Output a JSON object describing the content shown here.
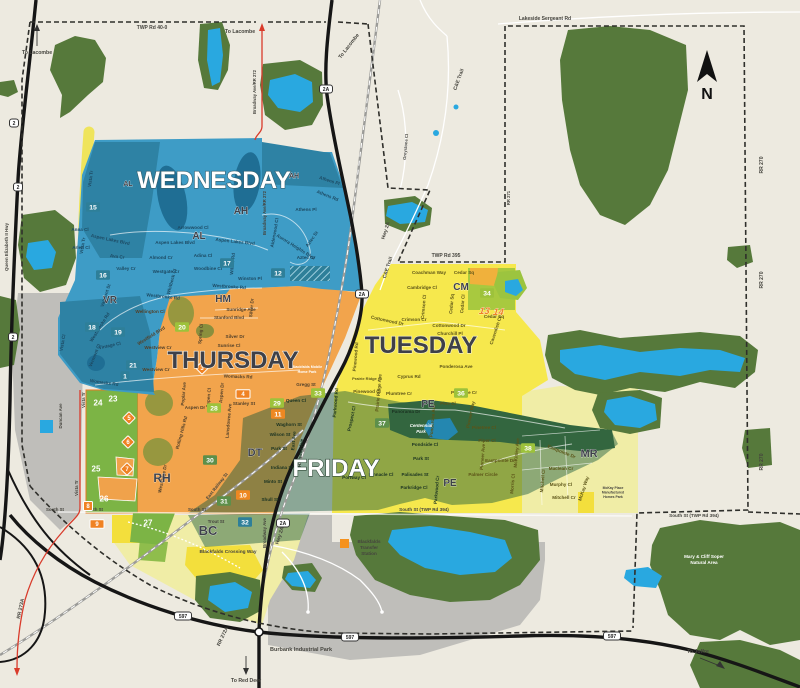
{
  "compass": {
    "label": "N"
  },
  "colors": {
    "wb": "#1D4A63",
    "th": "#53412A",
    "fr": "#1B3322",
    "tu": "#5C5418",
    "be": "#45443E",
    "wh": "#FFFFFF",
    "wednesday": "#3E9CC6",
    "thursday": "#F2A44C",
    "tuesday": "#F6E84D",
    "friday_overlay": "#14563C",
    "pale_yellow": "#F0EDA6",
    "zone_green": "#7CB445",
    "forest": "#56793B",
    "water": "#29A8E0",
    "gray": "#BFBEBA",
    "teal_box": "#2E7F99",
    "lime_box": "#9DC23B",
    "dgreen_box": "#5D8F4A",
    "orange_box": "#EE8822",
    "marker_orange": "#F08223",
    "red_route": "#D93B2B"
  },
  "day_titles": [
    {
      "t": "WEDNESDAY",
      "x": 214,
      "y": 188,
      "c": "#FFFFFF",
      "o": "#35606F"
    },
    {
      "t": "THURSDAY",
      "x": 233,
      "y": 368,
      "c": "#3E4049",
      "o": "#F7EFE2"
    },
    {
      "t": "TUESDAY",
      "x": 421,
      "y": 353,
      "c": "#3E4049",
      "o": "#F7F3C8"
    },
    {
      "t": "FRIDAY",
      "x": 336,
      "y": 476,
      "c": "#FFFFFF",
      "o": "#2F4A38"
    }
  ],
  "neighborhoods": [
    {
      "t": "AL",
      "x": 128,
      "y": 186,
      "s": 7
    },
    {
      "t": "AL",
      "x": 199,
      "y": 239,
      "s": 10
    },
    {
      "t": "AH",
      "x": 294,
      "y": 178,
      "s": 7
    },
    {
      "t": "AH",
      "x": 241,
      "y": 214,
      "s": 10
    },
    {
      "t": "VR",
      "x": 110,
      "y": 303,
      "s": 10
    },
    {
      "t": "HM",
      "x": 223,
      "y": 302,
      "s": 10
    },
    {
      "t": "RH",
      "x": 162,
      "y": 482,
      "s": 12
    },
    {
      "t": "DT",
      "x": 255,
      "y": 456,
      "s": 11
    },
    {
      "t": "BC",
      "x": 208,
      "y": 535,
      "s": 13
    },
    {
      "t": "CM",
      "x": 461,
      "y": 290,
      "s": 10
    },
    {
      "t": "PE",
      "x": 428,
      "y": 407,
      "s": 10
    },
    {
      "t": "PE",
      "x": 450,
      "y": 486,
      "s": 10
    },
    {
      "t": "MR",
      "x": 589,
      "y": 457,
      "s": 11
    }
  ],
  "zone_numbers": [
    {
      "t": "12",
      "x": 278,
      "y": 273,
      "b": "teal"
    },
    {
      "t": "15",
      "x": 93,
      "y": 207,
      "b": "teal"
    },
    {
      "t": "16",
      "x": 103,
      "y": 275,
      "b": "teal"
    },
    {
      "t": "17",
      "x": 227,
      "y": 263,
      "b": "teal"
    },
    {
      "t": "18",
      "x": 92,
      "y": 327,
      "b": "teal"
    },
    {
      "t": "19",
      "x": 118,
      "y": 332,
      "b": "teal"
    },
    {
      "t": "21",
      "x": 133,
      "y": 365,
      "b": "teal"
    },
    {
      "t": "1",
      "x": 125,
      "y": 376,
      "b": "teal"
    },
    {
      "t": "32",
      "x": 245,
      "y": 522,
      "b": "teal"
    },
    {
      "t": "20",
      "x": 182,
      "y": 327,
      "b": "lime"
    },
    {
      "t": "28",
      "x": 214,
      "y": 408,
      "b": "lime"
    },
    {
      "t": "29",
      "x": 277,
      "y": 403,
      "b": "lime"
    },
    {
      "t": "33",
      "x": 318,
      "y": 393,
      "b": "lime"
    },
    {
      "t": "34",
      "x": 487,
      "y": 293,
      "b": "lime"
    },
    {
      "t": "36",
      "x": 461,
      "y": 393,
      "b": "lime"
    },
    {
      "t": "38",
      "x": 528,
      "y": 448,
      "b": "lime"
    },
    {
      "t": "30",
      "x": 210,
      "y": 460,
      "b": "dgreen"
    },
    {
      "t": "31",
      "x": 224,
      "y": 501,
      "b": "dgreen"
    },
    {
      "t": "37",
      "x": 382,
      "y": 423,
      "b": "dgreen"
    },
    {
      "t": "10",
      "x": 243,
      "y": 495,
      "b": "orange"
    },
    {
      "t": "11",
      "x": 278,
      "y": 414,
      "b": "orange"
    },
    {
      "t": "23",
      "x": 113,
      "y": 399,
      "b": "plain"
    },
    {
      "t": "24",
      "x": 98,
      "y": 403,
      "b": "plain"
    },
    {
      "t": "25",
      "x": 96,
      "y": 469,
      "b": "plain"
    },
    {
      "t": "26",
      "x": 104,
      "y": 499,
      "b": "plain"
    },
    {
      "t": "27",
      "x": 148,
      "y": 523,
      "b": "plain"
    }
  ],
  "markers": [
    {
      "t": "3",
      "x": 202,
      "y": 368,
      "k": "diamond"
    },
    {
      "t": "5",
      "x": 129,
      "y": 418,
      "k": "diamond"
    },
    {
      "t": "6",
      "x": 128,
      "y": 442,
      "k": "diamond"
    },
    {
      "t": "7",
      "x": 127,
      "y": 469,
      "k": "diamond"
    },
    {
      "t": "4",
      "x": 243,
      "y": 394,
      "k": "rect"
    },
    {
      "t": "9",
      "x": 97,
      "y": 524,
      "k": "rect"
    },
    {
      "t": "8",
      "x": 88,
      "y": 506,
      "k": "square"
    },
    {
      "t": "13",
      "x": 484,
      "y": 311,
      "k": "plain"
    },
    {
      "t": "14",
      "x": 498,
      "y": 312,
      "k": "plain"
    }
  ],
  "shields": [
    {
      "t": "2",
      "x": 14,
      "y": 123
    },
    {
      "t": "2",
      "x": 18,
      "y": 187
    },
    {
      "t": "2",
      "x": 13,
      "y": 337
    },
    {
      "t": "2A",
      "x": 326,
      "y": 89
    },
    {
      "t": "2A",
      "x": 362,
      "y": 294
    },
    {
      "t": "2A",
      "x": 283,
      "y": 523
    },
    {
      "t": "597",
      "x": 183,
      "y": 616
    },
    {
      "t": "597",
      "x": 350,
      "y": 637
    },
    {
      "t": "597",
      "x": 612,
      "y": 636
    }
  ],
  "edge_labels": [
    {
      "t": "TWP Rd 40-0",
      "x": 152,
      "y": 29
    },
    {
      "t": "Lakeside Sergeant Rd",
      "x": 545,
      "y": 20
    },
    {
      "t": "TWP Rd 395",
      "x": 446,
      "y": 257
    },
    {
      "t": "South St",
      "x": 55,
      "y": 511,
      "s": 4.4
    },
    {
      "t": "South St",
      "x": 94,
      "y": 511,
      "s": 4.4
    },
    {
      "t": "South St",
      "x": 197,
      "y": 511,
      "s": 4.4
    },
    {
      "t": "South St (TWP Rd 394)",
      "x": 424,
      "y": 511,
      "s": 4.6
    },
    {
      "t": "South St (TWP Rd 394)",
      "x": 694,
      "y": 517,
      "s": 4.6
    },
    {
      "t": "RR 270",
      "x": 763,
      "y": 165,
      "r": -90
    },
    {
      "t": "RR 270",
      "x": 763,
      "y": 280,
      "r": -90
    },
    {
      "t": "RR 270",
      "x": 763,
      "y": 462,
      "r": -90
    },
    {
      "t": "RR 273A",
      "x": 22,
      "y": 609,
      "r": -78
    },
    {
      "t": "RR 272A",
      "x": 224,
      "y": 637,
      "r": -65
    },
    {
      "t": "Queen Elizabeth II Hwy",
      "x": 8,
      "y": 247,
      "r": -90,
      "s": 4.4
    },
    {
      "t": "Broadway Ave/RR 272",
      "x": 256,
      "y": 92,
      "r": -90,
      "s": 4.2
    },
    {
      "t": "Broadway Ave/RR 272",
      "x": 266,
      "y": 213,
      "r": -90,
      "s": 4.2
    },
    {
      "t": "Hwy 2A",
      "x": 387,
      "y": 231,
      "r": -72
    },
    {
      "t": "Hwy 2A",
      "x": 281,
      "y": 536,
      "r": -72
    },
    {
      "t": "Duncan Ave",
      "x": 62,
      "y": 416,
      "r": -90,
      "s": 4.4
    },
    {
      "t": "Vista Tr",
      "x": 85,
      "y": 400,
      "r": -90,
      "s": 4.4
    },
    {
      "t": "Vista Tr",
      "x": 78,
      "y": 488,
      "r": -90,
      "s": 4.4
    },
    {
      "t": "East Railway St",
      "x": 218,
      "y": 487,
      "r": -52,
      "s": 4.4
    },
    {
      "t": "Broadway Ave",
      "x": 266,
      "y": 533,
      "r": -90,
      "s": 4.4
    },
    {
      "t": "Trout St",
      "x": 216,
      "y": 523,
      "s": 4.4
    },
    {
      "t": "C&E Trail",
      "x": 460,
      "y": 80,
      "r": -70
    },
    {
      "t": "C&E Trail",
      "x": 389,
      "y": 268,
      "r": -72
    },
    {
      "t": "Greystone Cl",
      "x": 407,
      "y": 147,
      "r": -85,
      "s": 4.2
    },
    {
      "t": "RR 271",
      "x": 510,
      "y": 198,
      "r": -90,
      "s": 4.2
    },
    {
      "t": "Blackfalds Crossing Way",
      "x": 228,
      "y": 553,
      "s": 4.8
    }
  ],
  "directions": [
    {
      "t": "To Lacombe",
      "x": 37,
      "y": 54
    },
    {
      "t": "To Lacombe",
      "x": 240,
      "y": 33
    },
    {
      "t": "To Lacombe",
      "x": 350,
      "y": 47,
      "r": -52
    },
    {
      "t": "To Red Deer",
      "x": 246,
      "y": 682
    },
    {
      "t": "To Joffre",
      "x": 698,
      "y": 653
    }
  ],
  "landmarks": [
    {
      "t": "Blackfalds",
      "x": 369,
      "y": 543
    },
    {
      "t": "Transfer",
      "x": 369,
      "y": 549
    },
    {
      "t": "Station",
      "x": 369,
      "y": 555
    },
    {
      "t": "Burbank Industrial Park",
      "x": 301,
      "y": 651,
      "s": 5.5
    },
    {
      "t": "Centennial",
      "x": 421,
      "y": 427,
      "c": "wh",
      "i": 1,
      "s": 4.4
    },
    {
      "t": "Park",
      "x": 421,
      "y": 433,
      "c": "wh",
      "i": 1,
      "s": 4.4
    },
    {
      "t": "Mary & Cliff Soper",
      "x": 704,
      "y": 558,
      "c": "wh"
    },
    {
      "t": "Natural Area",
      "x": 704,
      "y": 564,
      "c": "wh"
    },
    {
      "t": "Blackfalds Mobile",
      "x": 307,
      "y": 368,
      "c": "wh",
      "s": 3.6
    },
    {
      "t": "Home Park",
      "x": 307,
      "y": 373,
      "c": "wh",
      "s": 3.6
    },
    {
      "t": "McKay Place",
      "x": 613,
      "y": 489,
      "s": 3.4
    },
    {
      "t": "Manufactured",
      "x": 613,
      "y": 493.5,
      "s": 3.4
    },
    {
      "t": "Homes Park",
      "x": 613,
      "y": 498,
      "s": 3.4
    }
  ],
  "streets": [
    {
      "t": "Vista Tr",
      "x": 92,
      "y": 179,
      "r": -82,
      "c": "wb"
    },
    {
      "t": "Athens Pl",
      "x": 329,
      "y": 182,
      "r": 18,
      "c": "wb"
    },
    {
      "t": "Athens Rd",
      "x": 327,
      "y": 197,
      "r": 22,
      "c": "wb"
    },
    {
      "t": "Athens Pl",
      "x": 306,
      "y": 211,
      "c": "wb"
    },
    {
      "t": "Arrowwood Cl",
      "x": 193,
      "y": 229,
      "c": "wb"
    },
    {
      "t": "Aspen Lakes Blvd",
      "x": 110,
      "y": 241,
      "r": 12,
      "c": "wb"
    },
    {
      "t": "Anna Cl",
      "x": 80,
      "y": 231,
      "c": "wb"
    },
    {
      "t": "Arlen Cl",
      "x": 81,
      "y": 249,
      "c": "wb"
    },
    {
      "t": "Ava Cr",
      "x": 117,
      "y": 258,
      "r": 8,
      "c": "wb"
    },
    {
      "t": "Aspen Lakes Blvd",
      "x": 175,
      "y": 244,
      "c": "wb"
    },
    {
      "t": "Aspen Lakes Blvd",
      "x": 235,
      "y": 243,
      "r": 6,
      "c": "wb"
    },
    {
      "t": "Almond Cr",
      "x": 161,
      "y": 259,
      "c": "wb"
    },
    {
      "t": "Adina Cl",
      "x": 203,
      "y": 257,
      "c": "wb"
    },
    {
      "t": "Woodbine Cl",
      "x": 208,
      "y": 270,
      "c": "wb"
    },
    {
      "t": "Willow Rd",
      "x": 234,
      "y": 264,
      "r": -85,
      "c": "wb"
    },
    {
      "t": "Winston Pl",
      "x": 250,
      "y": 280,
      "c": "wb"
    },
    {
      "t": "Westbrooke Rd",
      "x": 229,
      "y": 288,
      "r": 4,
      "c": "wb"
    },
    {
      "t": "Westbrooke Rd",
      "x": 163,
      "y": 298,
      "r": 6,
      "c": "wb"
    },
    {
      "t": "Valley Cr",
      "x": 126,
      "y": 270,
      "c": "wb"
    },
    {
      "t": "Westgate Cr",
      "x": 166,
      "y": 273,
      "c": "wb"
    },
    {
      "t": "Whitbeck Cl",
      "x": 173,
      "y": 282,
      "r": -75,
      "c": "wb"
    },
    {
      "t": "Vista Tr",
      "x": 84,
      "y": 246,
      "r": -80,
      "c": "wb"
    },
    {
      "t": "Valmont St",
      "x": 107,
      "y": 296,
      "r": -72,
      "c": "wb"
    },
    {
      "t": "Vermont Cl",
      "x": 96,
      "y": 356,
      "r": -68,
      "c": "wb"
    },
    {
      "t": "Westbrooke Rd",
      "x": 101,
      "y": 328,
      "r": -58,
      "c": "wb"
    },
    {
      "t": "Aurora Heights Blvd",
      "x": 295,
      "y": 248,
      "r": 32,
      "c": "wb"
    },
    {
      "t": "Alderwood Cl",
      "x": 276,
      "y": 233,
      "r": -80,
      "c": "wb"
    },
    {
      "t": "Aztec St",
      "x": 313,
      "y": 240,
      "r": -55,
      "c": "wb"
    },
    {
      "t": "Aztec Cr",
      "x": 306,
      "y": 259,
      "c": "wb"
    },
    {
      "t": "Vintage Cl",
      "x": 110,
      "y": 347,
      "r": -12,
      "c": "wb"
    },
    {
      "t": "Vista Cl",
      "x": 64,
      "y": 343,
      "r": -80,
      "c": "wb"
    },
    {
      "t": "Womacks Rd",
      "x": 104,
      "y": 384,
      "r": 8,
      "c": "wb"
    },
    {
      "t": "Wellington Cl",
      "x": 150,
      "y": 313,
      "c": "th"
    },
    {
      "t": "Westfield Blvd",
      "x": 152,
      "y": 337,
      "r": -32,
      "c": "th"
    },
    {
      "t": "Westview Cr",
      "x": 158,
      "y": 349,
      "c": "th"
    },
    {
      "t": "Westview Cr",
      "x": 156,
      "y": 371,
      "c": "th"
    },
    {
      "t": "Sunridge Ave",
      "x": 241,
      "y": 311,
      "c": "th"
    },
    {
      "t": "Stanford Blvd",
      "x": 229,
      "y": 319,
      "c": "th"
    },
    {
      "t": "Silver Dr",
      "x": 235,
      "y": 338,
      "c": "th"
    },
    {
      "t": "Sunrise Cl",
      "x": 229,
      "y": 347,
      "c": "th"
    },
    {
      "t": "Spring Cl",
      "x": 202,
      "y": 334,
      "r": -85,
      "c": "th"
    },
    {
      "t": "Silver Dr",
      "x": 253,
      "y": 308,
      "r": -85,
      "c": "th"
    },
    {
      "t": "Womacks Rd",
      "x": 238,
      "y": 378,
      "r": 2,
      "c": "th"
    },
    {
      "t": "Poplar Ave",
      "x": 185,
      "y": 394,
      "r": -85,
      "c": "th"
    },
    {
      "t": "Aspen Dr",
      "x": 195,
      "y": 409,
      "c": "th"
    },
    {
      "t": "Aspen Cl",
      "x": 210,
      "y": 398,
      "r": -85,
      "c": "th"
    },
    {
      "t": "Aspen Dr",
      "x": 223,
      "y": 393,
      "r": -85,
      "c": "th"
    },
    {
      "t": "Lansdowne Ave",
      "x": 230,
      "y": 421,
      "r": -85,
      "c": "th"
    },
    {
      "t": "Stanley St",
      "x": 244,
      "y": 405,
      "c": "th"
    },
    {
      "t": "Gregg St",
      "x": 306,
      "y": 386,
      "c": "th"
    },
    {
      "t": "Westridge Dr",
      "x": 164,
      "y": 479,
      "r": -78,
      "c": "th"
    },
    {
      "t": "Rolling Hills Rd",
      "x": 183,
      "y": 433,
      "r": -75,
      "c": "th"
    },
    {
      "t": "Waghorn St",
      "x": 289,
      "y": 426,
      "c": "fr"
    },
    {
      "t": "Wilson St",
      "x": 280,
      "y": 436,
      "c": "fr"
    },
    {
      "t": "Park St",
      "x": 279,
      "y": 450,
      "c": "fr"
    },
    {
      "t": "Indiana St",
      "x": 282,
      "y": 469,
      "c": "fr"
    },
    {
      "t": "Minto St",
      "x": 273,
      "y": 483,
      "c": "fr"
    },
    {
      "t": "Shull St",
      "x": 270,
      "y": 501,
      "c": "fr"
    },
    {
      "t": "East Ave",
      "x": 295,
      "y": 441,
      "r": -85,
      "c": "fr"
    },
    {
      "t": "Highway Ave",
      "x": 302,
      "y": 453,
      "r": -85,
      "c": "fr"
    },
    {
      "t": "Queen Cl",
      "x": 296,
      "y": 402,
      "c": "fr"
    },
    {
      "t": "Panorama Dr",
      "x": 406,
      "y": 413,
      "c": "fr"
    },
    {
      "t": "Pondside Cl",
      "x": 425,
      "y": 446,
      "c": "fr"
    },
    {
      "t": "Park St",
      "x": 421,
      "y": 460,
      "c": "fr"
    },
    {
      "t": "Palisades St",
      "x": 415,
      "y": 476,
      "c": "fr"
    },
    {
      "t": "Parkridge Cl",
      "x": 414,
      "y": 489,
      "c": "fr"
    },
    {
      "t": "Pinnacle Cl",
      "x": 381,
      "y": 476,
      "c": "fr"
    },
    {
      "t": "Portway Cl",
      "x": 354,
      "y": 479,
      "c": "fr"
    },
    {
      "t": "Parkwood Cr",
      "x": 438,
      "y": 490,
      "r": -85,
      "c": "fr"
    },
    {
      "t": "Parkwood Rd",
      "x": 337,
      "y": 403,
      "r": -85,
      "c": "fr"
    },
    {
      "t": "Prospect Cl",
      "x": 353,
      "y": 419,
      "r": -78,
      "c": "fr"
    },
    {
      "t": "Coachman Way",
      "x": 429,
      "y": 274,
      "c": "tu"
    },
    {
      "t": "Cedar Sq",
      "x": 464,
      "y": 274,
      "c": "tu"
    },
    {
      "t": "Cambridge Cl",
      "x": 422,
      "y": 289,
      "c": "tu"
    },
    {
      "t": "Crimson Cl",
      "x": 425,
      "y": 307,
      "r": -85,
      "c": "tu"
    },
    {
      "t": "Crimson Cr",
      "x": 414,
      "y": 321,
      "c": "tu"
    },
    {
      "t": "Cottonwood Dr",
      "x": 387,
      "y": 322,
      "r": 12,
      "c": "tu"
    },
    {
      "t": "Cottonwood Dr",
      "x": 449,
      "y": 327,
      "c": "tu"
    },
    {
      "t": "Cedar Sq",
      "x": 453,
      "y": 304,
      "r": -85,
      "c": "tu"
    },
    {
      "t": "Cedar Cl",
      "x": 464,
      "y": 304,
      "r": -85,
      "c": "tu"
    },
    {
      "t": "Cedar Sq",
      "x": 494,
      "y": 318,
      "c": "tu"
    },
    {
      "t": "Churchill Pl",
      "x": 450,
      "y": 335,
      "c": "tu"
    },
    {
      "t": "Cavendish Cl",
      "x": 497,
      "y": 331,
      "r": -72,
      "c": "tu"
    },
    {
      "t": "Ponderosa Ave",
      "x": 456,
      "y": 368,
      "c": "tu"
    },
    {
      "t": "Ponderosa Ave",
      "x": 434,
      "y": 421,
      "r": -85,
      "c": "tu"
    },
    {
      "t": "Cyprus Rd",
      "x": 409,
      "y": 378,
      "c": "tu"
    },
    {
      "t": "Prairie Ridge Ave",
      "x": 380,
      "y": 393,
      "r": -85,
      "c": "tu"
    },
    {
      "t": "Prairie Ridge Cl",
      "x": 367,
      "y": 380,
      "s": 4,
      "c": "tu"
    },
    {
      "t": "Pinewood Cl",
      "x": 367,
      "y": 393,
      "c": "tu"
    },
    {
      "t": "Plumtree Cr",
      "x": 399,
      "y": 395,
      "c": "tu"
    },
    {
      "t": "Plumtree Cr",
      "x": 464,
      "y": 394,
      "c": "tu"
    },
    {
      "t": "Pine Cl",
      "x": 448,
      "y": 405,
      "c": "tu"
    },
    {
      "t": "Pinewood Rd",
      "x": 357,
      "y": 357,
      "r": -85,
      "c": "tu"
    },
    {
      "t": "Pioneer Way",
      "x": 472,
      "y": 415,
      "r": -78,
      "c": "tu"
    },
    {
      "t": "Pinetree Cl",
      "x": 484,
      "y": 429,
      "c": "tu"
    },
    {
      "t": "Piper Cl",
      "x": 487,
      "y": 442,
      "c": "tu"
    },
    {
      "t": "Pioneer Ave",
      "x": 484,
      "y": 457,
      "r": -85,
      "c": "tu"
    },
    {
      "t": "Palmer Circle",
      "x": 483,
      "y": 476,
      "c": "tu"
    },
    {
      "t": "Eastpointe Dr",
      "x": 500,
      "y": 462,
      "c": "tu"
    },
    {
      "t": "Eastpointe Dr",
      "x": 561,
      "y": 453,
      "r": 22,
      "c": "tu"
    },
    {
      "t": "McKinley Ave",
      "x": 518,
      "y": 453,
      "r": -85,
      "c": "tu"
    },
    {
      "t": "Morris Cl",
      "x": 514,
      "y": 484,
      "r": -85,
      "c": "tu"
    },
    {
      "t": "Mitchell Cl",
      "x": 544,
      "y": 481,
      "r": -85,
      "c": "tu"
    },
    {
      "t": "Maclean Cr",
      "x": 561,
      "y": 470,
      "c": "tu"
    },
    {
      "t": "Murphy Cl",
      "x": 561,
      "y": 486,
      "c": "tu"
    },
    {
      "t": "Mitchell Cr",
      "x": 564,
      "y": 499,
      "c": "tu"
    },
    {
      "t": "McKay Way",
      "x": 585,
      "y": 489,
      "r": -72,
      "c": "tu"
    }
  ]
}
